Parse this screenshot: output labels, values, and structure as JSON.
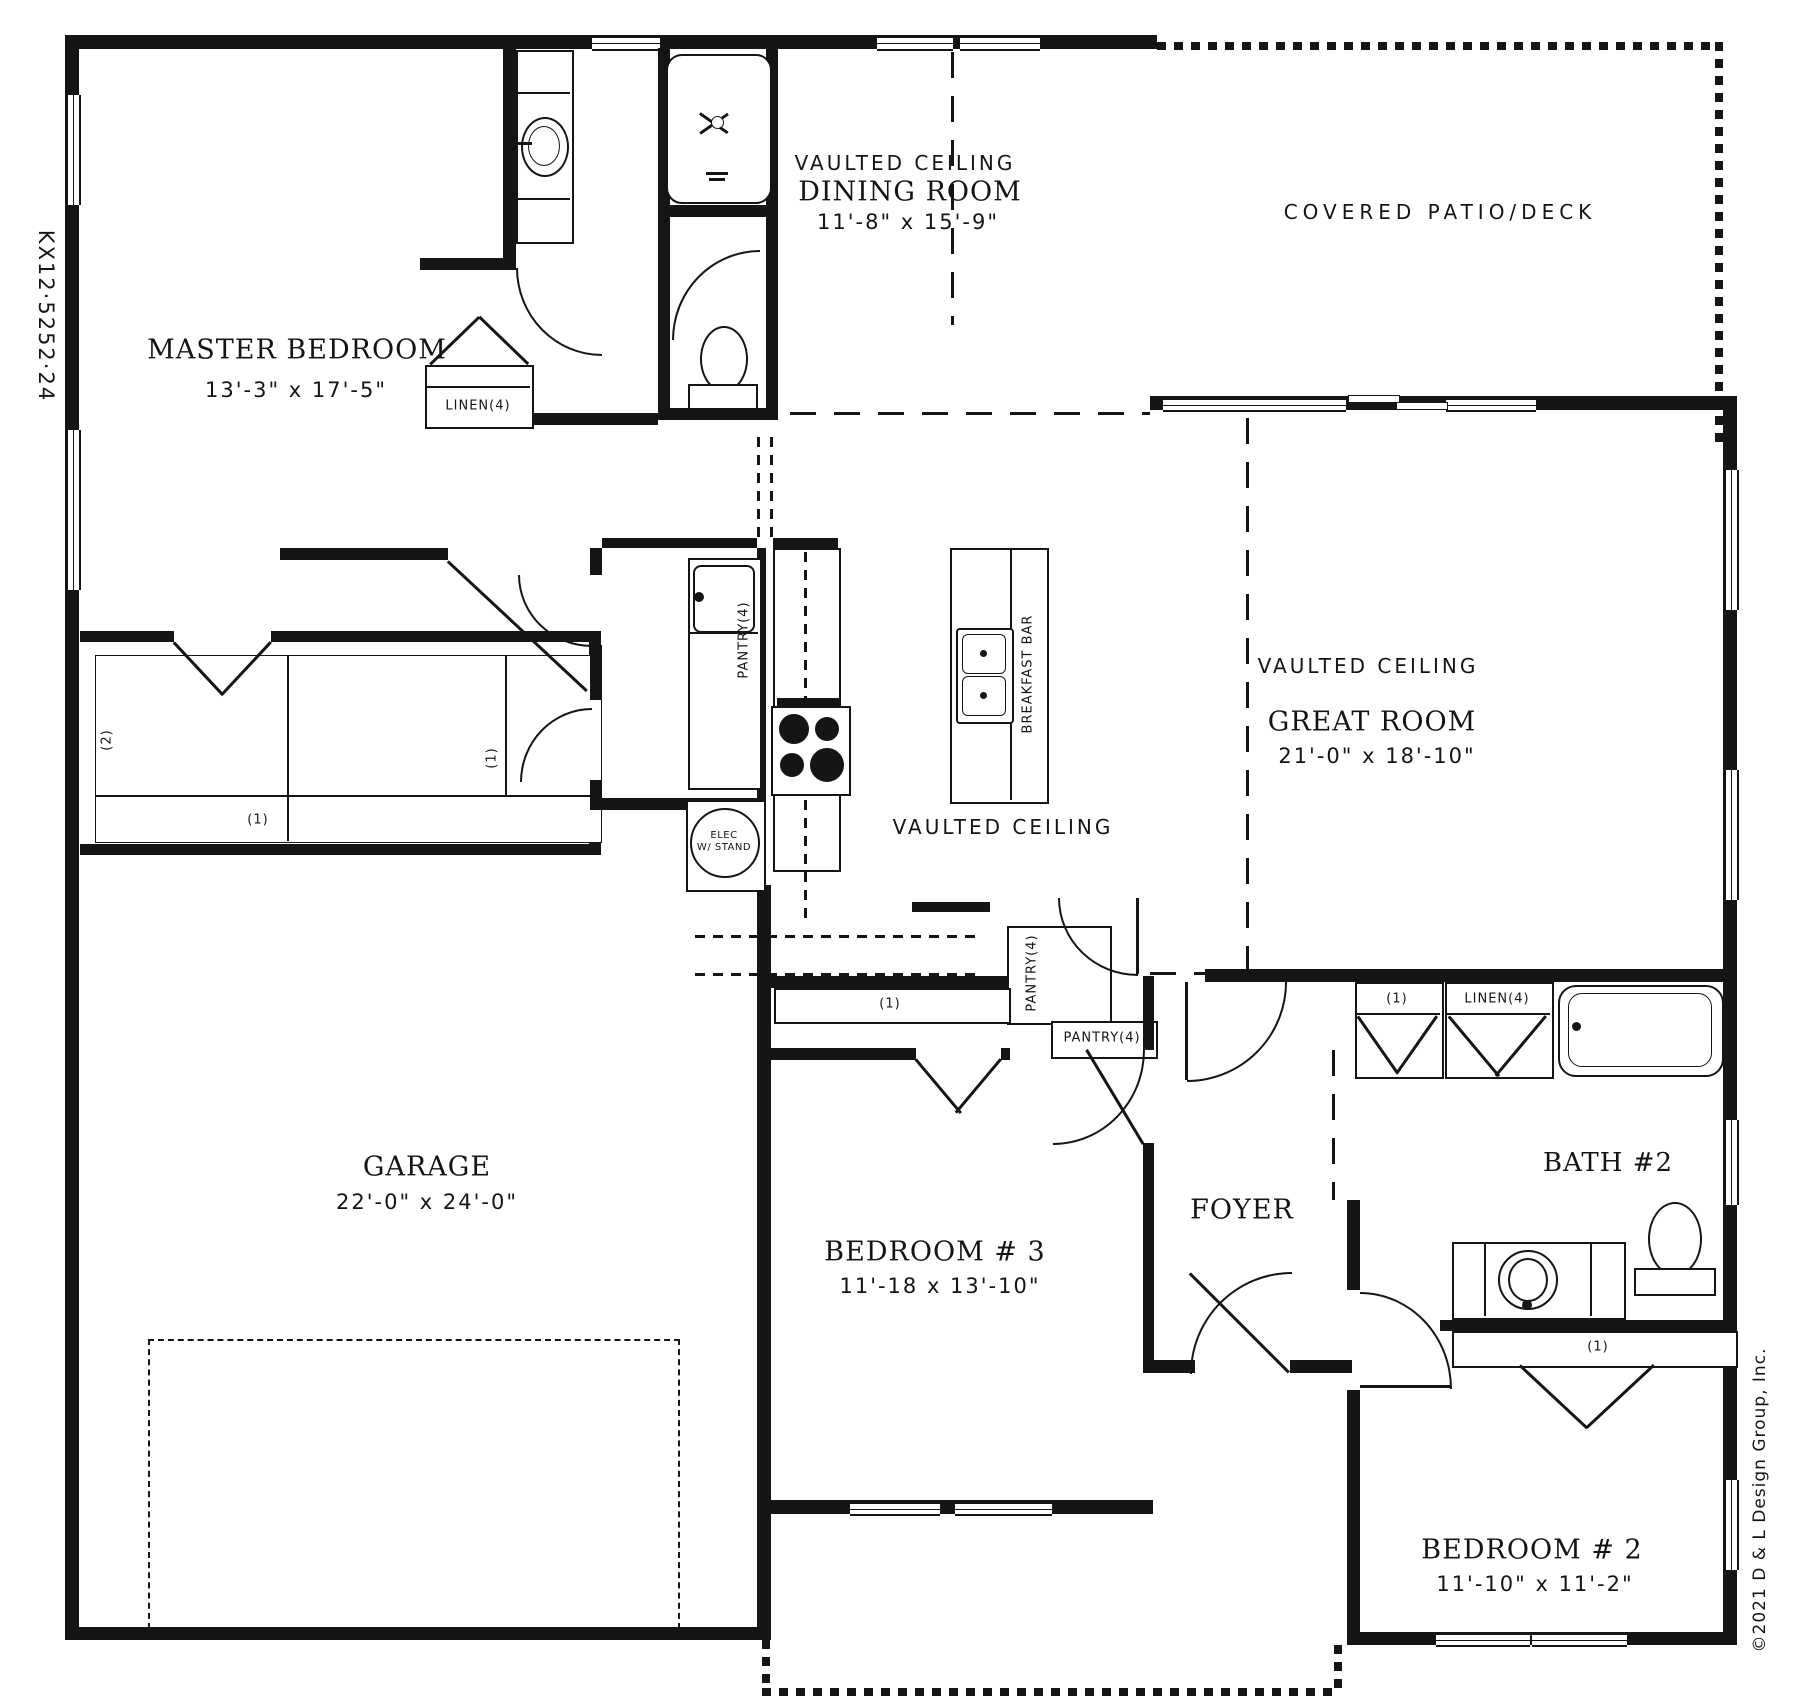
{
  "plan_code": "KX12·5252·24",
  "copyright": "©2021 D & L Design Group, Inc.",
  "rooms": {
    "master": {
      "name": "MASTER BEDROOM",
      "dims": "13'-3\" x 17'-5\""
    },
    "dining": {
      "vault": "VAULTED CEILING",
      "name": "DINING ROOM",
      "dims": "11'-8\" x 15'-9\""
    },
    "patio": {
      "name": "COVERED PATIO/DECK"
    },
    "great": {
      "vault": "VAULTED CEILING",
      "name": "GREAT ROOM",
      "dims": "21'-0\" x 18'-10\""
    },
    "kitchen": {
      "vault": "VAULTED CEILING"
    },
    "garage": {
      "name": "GARAGE",
      "dims": "22'-0\" x 24'-0\""
    },
    "bed3": {
      "name": "BEDROOM # 3",
      "dims": "11'-18 x 13'-10\""
    },
    "foyer": {
      "name": "FOYER"
    },
    "bath2": {
      "name": "BATH #2"
    },
    "bed2": {
      "name": "BEDROOM # 2",
      "dims": "11'-10\" x 11'-2\""
    }
  },
  "labels": {
    "linen": "LINEN(4)",
    "pantry": "PANTRY(4)",
    "breakfast_bar": "BREAKFAST BAR",
    "elec1": "ELEC",
    "elec2": "W/ STAND",
    "s1": "(1)",
    "s2": "(2)"
  }
}
